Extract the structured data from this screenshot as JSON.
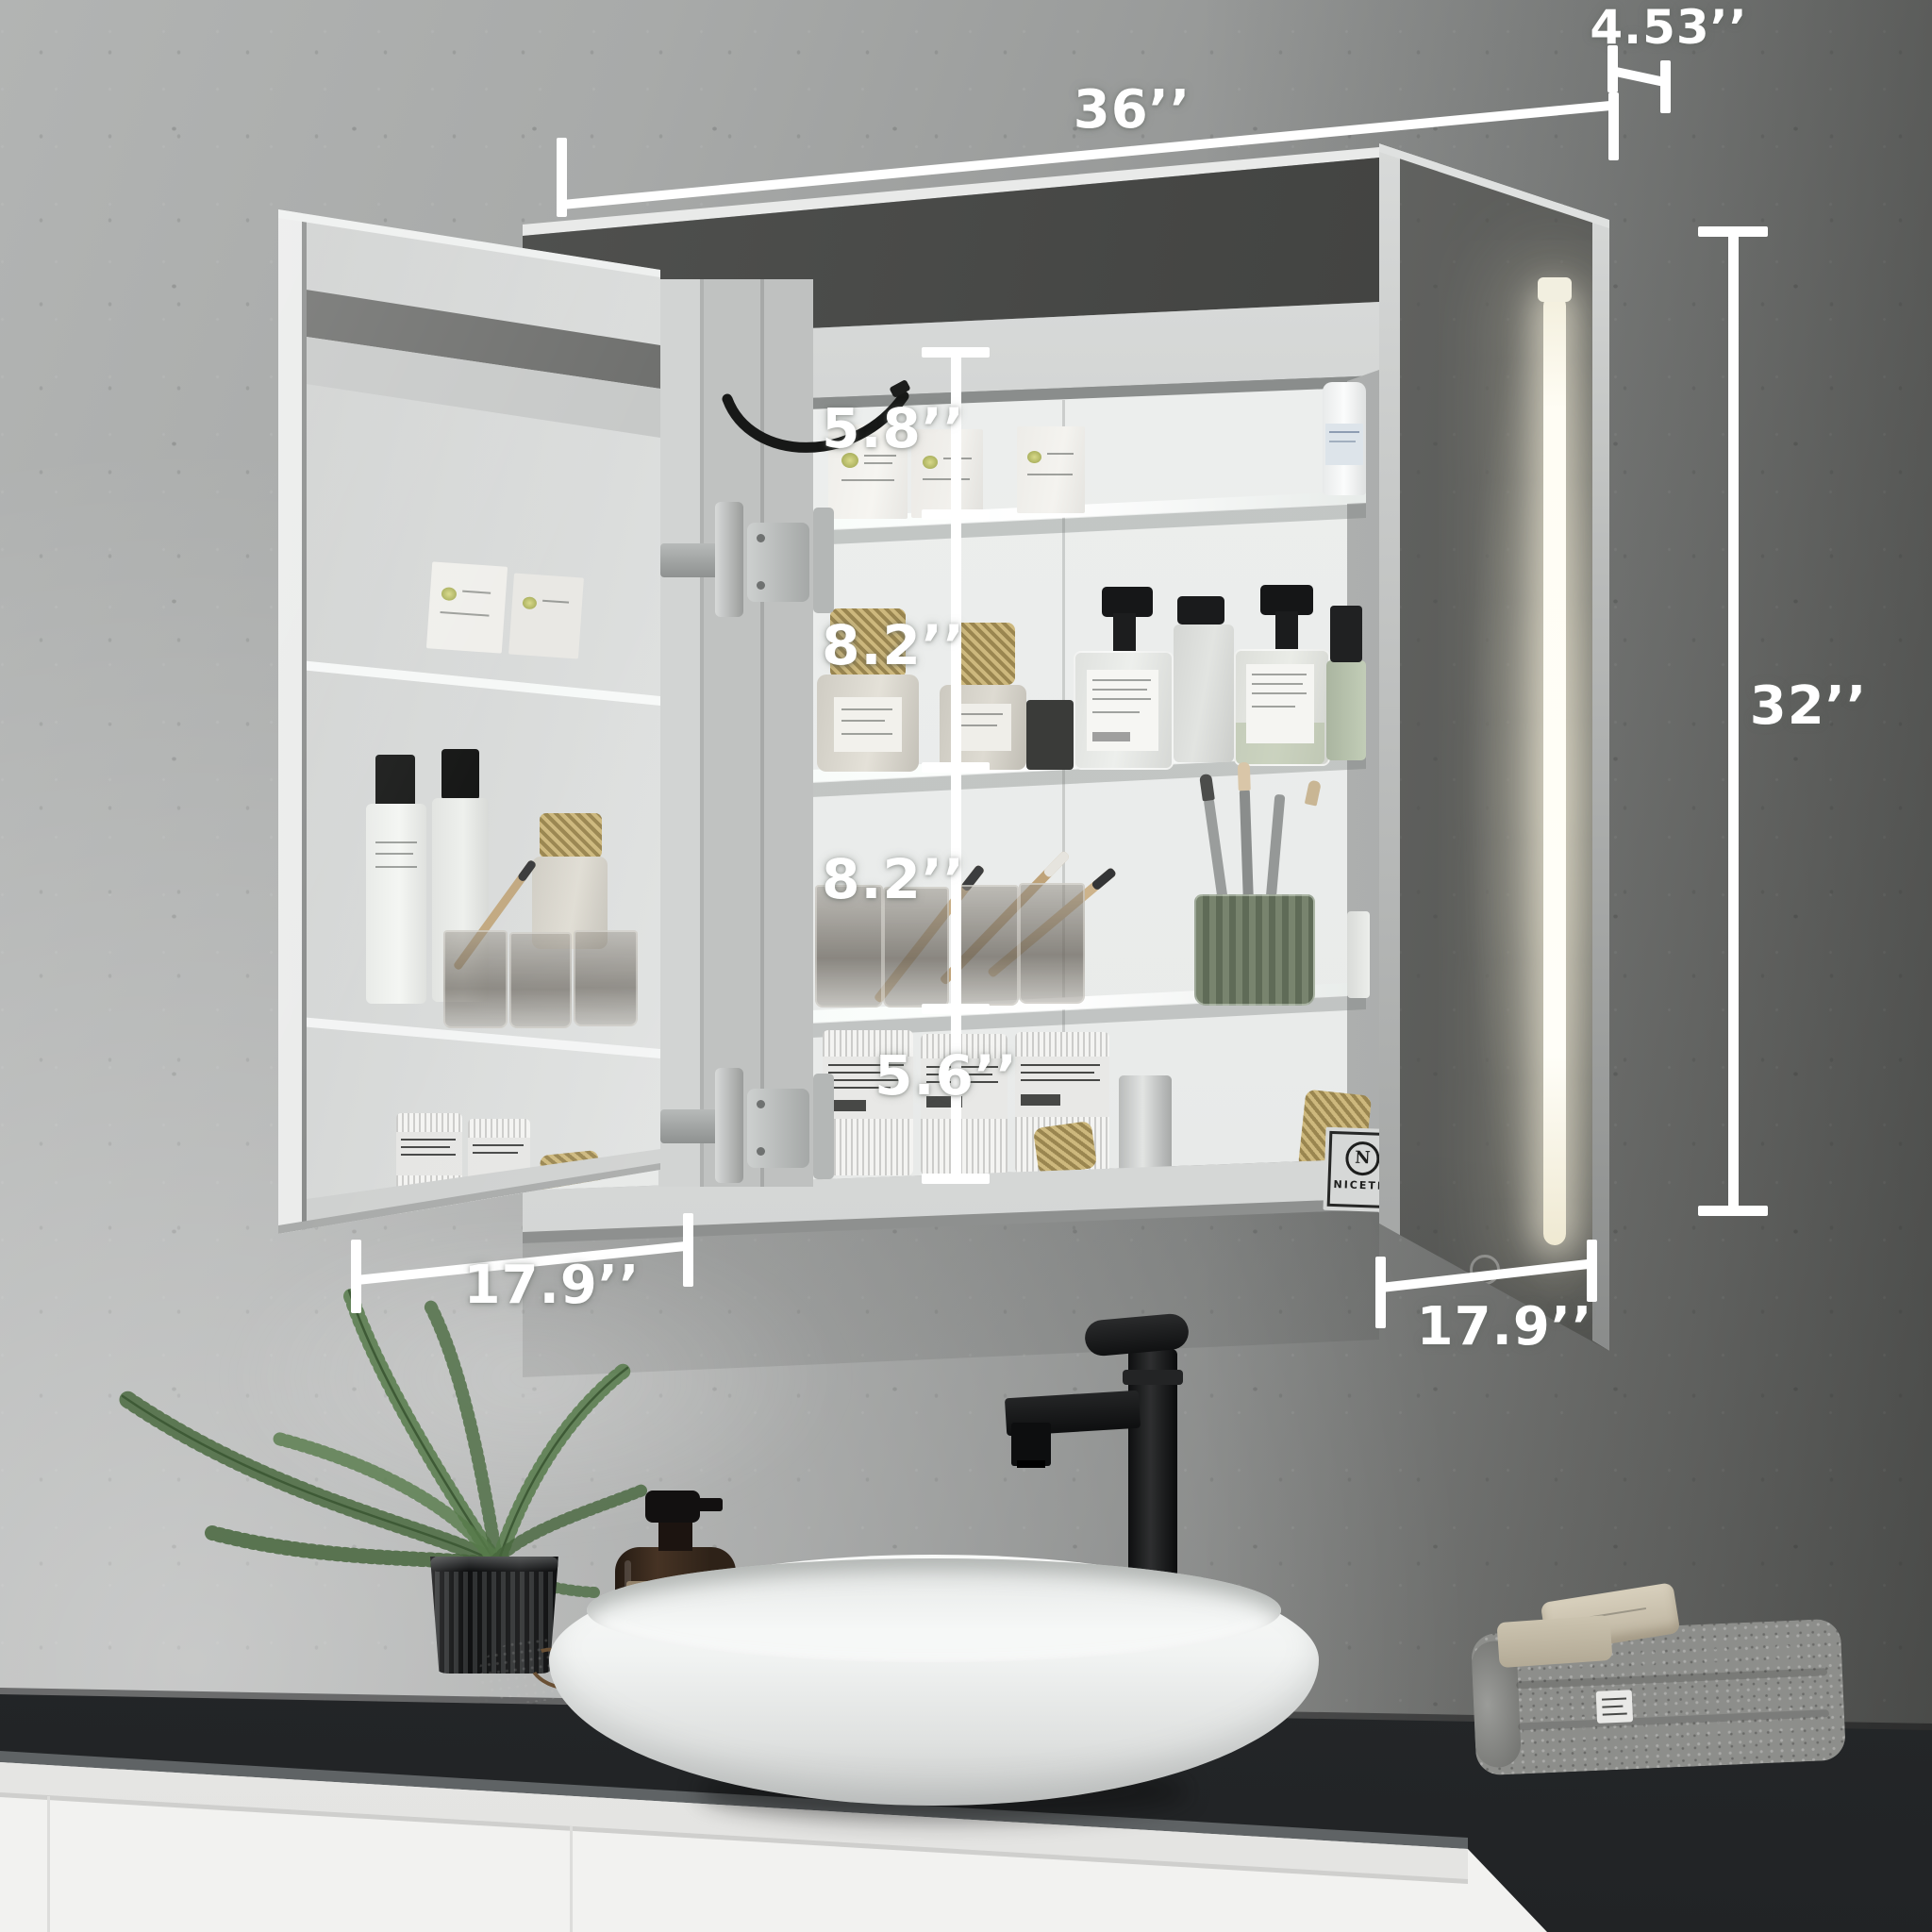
{
  "annotations": {
    "cabinet_width": "36’’",
    "door_depth": "4.53’’",
    "cabinet_height": "32’’",
    "gap_top": "5.8’’",
    "gap_middle_upper": "8.2’’",
    "gap_middle_lower": "8.2’’",
    "gap_bottom": "5.6’’",
    "left_door_width": "17.9’’",
    "right_door_width": "17.9’’"
  },
  "brand_plate": {
    "initial": "N",
    "name": "NICETE"
  },
  "products": {
    "soap_bottle_label": "hand soap"
  },
  "palette": {
    "annotation_color": "#ffffff",
    "wall_light": "#c9cbca",
    "wall_dark": "#595a58",
    "counter": "#2c2f31",
    "vanity_white": "#f2f2f0",
    "led_glow": "#fdf8e3",
    "plant_green": "#4c6b42",
    "soap_amber": "#3a2a1e"
  }
}
